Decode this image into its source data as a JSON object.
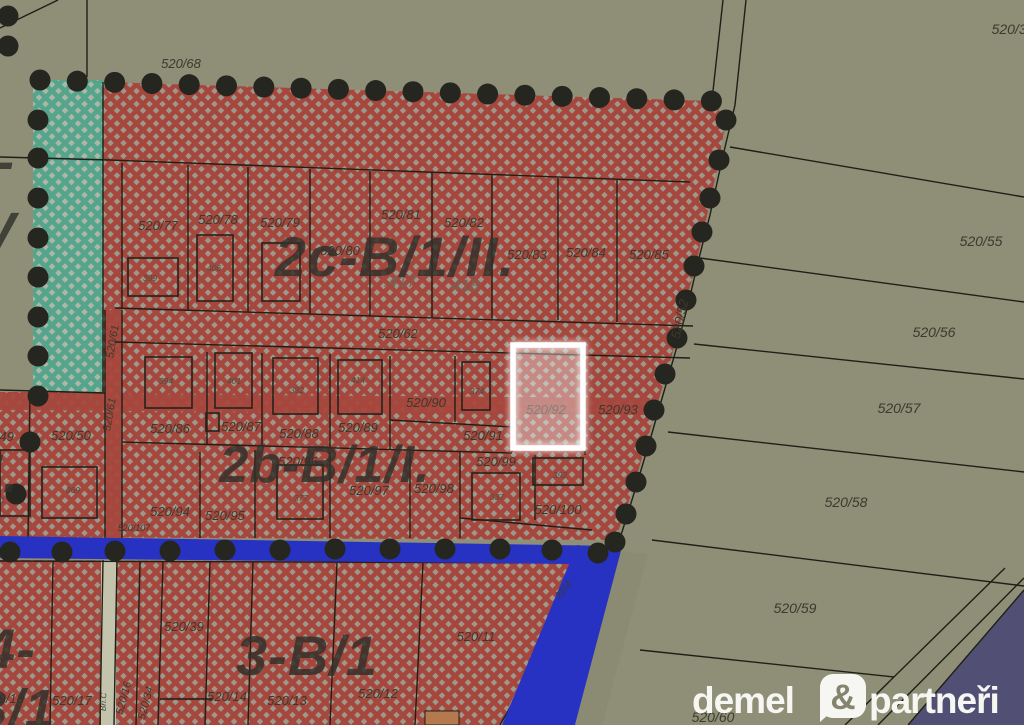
{
  "colors": {
    "bg": "#8e8f76",
    "red": "#a6473d",
    "red_bg": "#9d978c",
    "green": "#55a48c",
    "green_bg": "#aeb6a8",
    "road_blue": "#2832c2",
    "road_indigo": "#515074",
    "road_gray": "#8b8b74",
    "street_light": "#c4c4ad",
    "dots": "#262620",
    "line": "#1f1f18",
    "label": "#3a3a2e",
    "zone": "#30302a",
    "highlight": "#ffffff",
    "logo": "#f6f6f2"
  },
  "map": {
    "highlight": {
      "parcel": "520/92"
    },
    "zone_labels": [
      {
        "t": "2c-B/1/II.",
        "x": 395,
        "y": 276,
        "s": 56
      },
      {
        "t": "2b-B/1/I.",
        "x": 325,
        "y": 482,
        "s": 52
      },
      {
        "t": "3-B/1",
        "x": 307,
        "y": 675,
        "s": 56
      },
      {
        "t": "4-",
        "x": 10,
        "y": 668,
        "s": 56
      },
      {
        "t": "B/1",
        "x": 12,
        "y": 727,
        "s": 54
      },
      {
        "t": "5-",
        "x": -10,
        "y": 180,
        "s": 54
      },
      {
        "t": "V",
        "x": -2,
        "y": 250,
        "s": 54
      },
      {
        "t": "/I.",
        "x": -5,
        "y": 492,
        "s": 54
      }
    ],
    "parcel_labels": [
      {
        "t": "520/68",
        "x": 181,
        "y": 68
      },
      {
        "t": "520/38",
        "x": 1013,
        "y": 34,
        "s": 14
      },
      {
        "t": "520/55",
        "x": 981,
        "y": 246,
        "s": 14
      },
      {
        "t": "520/56",
        "x": 934,
        "y": 337,
        "s": 14
      },
      {
        "t": "520/57",
        "x": 899,
        "y": 413,
        "s": 14
      },
      {
        "t": "520/58",
        "x": 846,
        "y": 507,
        "s": 14
      },
      {
        "t": "520/59",
        "x": 795,
        "y": 613,
        "s": 14
      },
      {
        "t": "520/60",
        "x": 713,
        "y": 722,
        "s": 14
      },
      {
        "t": "520/77",
        "x": 158,
        "y": 230
      },
      {
        "t": "520/78",
        "x": 218,
        "y": 224
      },
      {
        "t": "520/79",
        "x": 280,
        "y": 227
      },
      {
        "t": "520/80",
        "x": 340,
        "y": 255
      },
      {
        "t": "520/81",
        "x": 401,
        "y": 219
      },
      {
        "t": "520/82",
        "x": 464,
        "y": 227
      },
      {
        "t": "520/83",
        "x": 527,
        "y": 259
      },
      {
        "t": "520/84",
        "x": 586,
        "y": 257
      },
      {
        "t": "520/85",
        "x": 649,
        "y": 259
      },
      {
        "t": "520/62",
        "x": 398,
        "y": 338
      },
      {
        "t": "520/52",
        "x": 684,
        "y": 320,
        "r": -77
      },
      {
        "t": "520/61",
        "x": 116,
        "y": 342,
        "r": -80,
        "s": 11
      },
      {
        "t": "520/61",
        "x": 113,
        "y": 415,
        "r": -80,
        "s": 11
      },
      {
        "t": "520/49",
        "x": -6,
        "y": 441
      },
      {
        "t": "520/50",
        "x": 71,
        "y": 440
      },
      {
        "t": "520/86",
        "x": 170,
        "y": 433
      },
      {
        "t": "520/87",
        "x": 241,
        "y": 431
      },
      {
        "t": "520/88",
        "x": 299,
        "y": 438
      },
      {
        "t": "520/89",
        "x": 358,
        "y": 432
      },
      {
        "t": "520/90",
        "x": 426,
        "y": 407
      },
      {
        "t": "520/91",
        "x": 483,
        "y": 440
      },
      {
        "t": "520/92",
        "x": 546,
        "y": 414
      },
      {
        "t": "520/93",
        "x": 618,
        "y": 414
      },
      {
        "t": "520/94",
        "x": 170,
        "y": 516
      },
      {
        "t": "520/95",
        "x": 225,
        "y": 520
      },
      {
        "t": "520/96",
        "x": 298,
        "y": 466
      },
      {
        "t": "520/97",
        "x": 369,
        "y": 495
      },
      {
        "t": "520/98",
        "x": 434,
        "y": 493
      },
      {
        "t": "520/99",
        "x": 496,
        "y": 466
      },
      {
        "t": "520/100",
        "x": 558,
        "y": 514
      },
      {
        "t": "520/107",
        "x": 134,
        "y": 531,
        "s": 9
      },
      {
        "t": "520/39",
        "x": 184,
        "y": 631
      },
      {
        "t": "520/11",
        "x": 476,
        "y": 641
      },
      {
        "t": "520/12",
        "x": 378,
        "y": 698
      },
      {
        "t": "520/13",
        "x": 287,
        "y": 705
      },
      {
        "t": "520/14",
        "x": 227,
        "y": 701
      },
      {
        "t": "520/17",
        "x": 72,
        "y": 705
      },
      {
        "t": "520/18",
        "x": 4,
        "y": 703
      },
      {
        "t": "520/16",
        "x": 127,
        "y": 699,
        "r": -75,
        "s": 11
      },
      {
        "t": "520/34",
        "x": 149,
        "y": 704,
        "r": -75,
        "s": 11
      },
      {
        "t": "22/4",
        "x": 566,
        "y": 592,
        "r": -50,
        "s": 10
      },
      {
        "t": "Bří.Č",
        "x": 106,
        "y": 702,
        "r": -88,
        "s": 8
      }
    ],
    "house_labels": [
      {
        "t": "399",
        "x": 150,
        "y": 281
      },
      {
        "t": "406",
        "x": 214,
        "y": 271
      },
      {
        "t": ".417",
        "x": 400,
        "y": 287,
        "s": 17,
        "big": true
      },
      {
        "t": ".418",
        "x": 463,
        "y": 291,
        "s": 17,
        "big": true
      },
      {
        "t": "394",
        "x": 166,
        "y": 384
      },
      {
        "t": "401",
        "x": 234,
        "y": 384
      },
      {
        "t": "392",
        "x": 297,
        "y": 393
      },
      {
        "t": "414",
        "x": 358,
        "y": 383
      },
      {
        "t": "374",
        "x": 477,
        "y": 394
      },
      {
        "t": "369",
        "x": 73,
        "y": 493
      },
      {
        "t": "371",
        "x": -2,
        "y": 503
      },
      {
        "t": "377",
        "x": 301,
        "y": 501
      },
      {
        "t": "337",
        "x": 497,
        "y": 500
      },
      {
        "t": "392",
        "x": 560,
        "y": 478
      }
    ]
  },
  "logo": {
    "word1": "demel",
    "amp": "&",
    "word2": "partneři"
  }
}
